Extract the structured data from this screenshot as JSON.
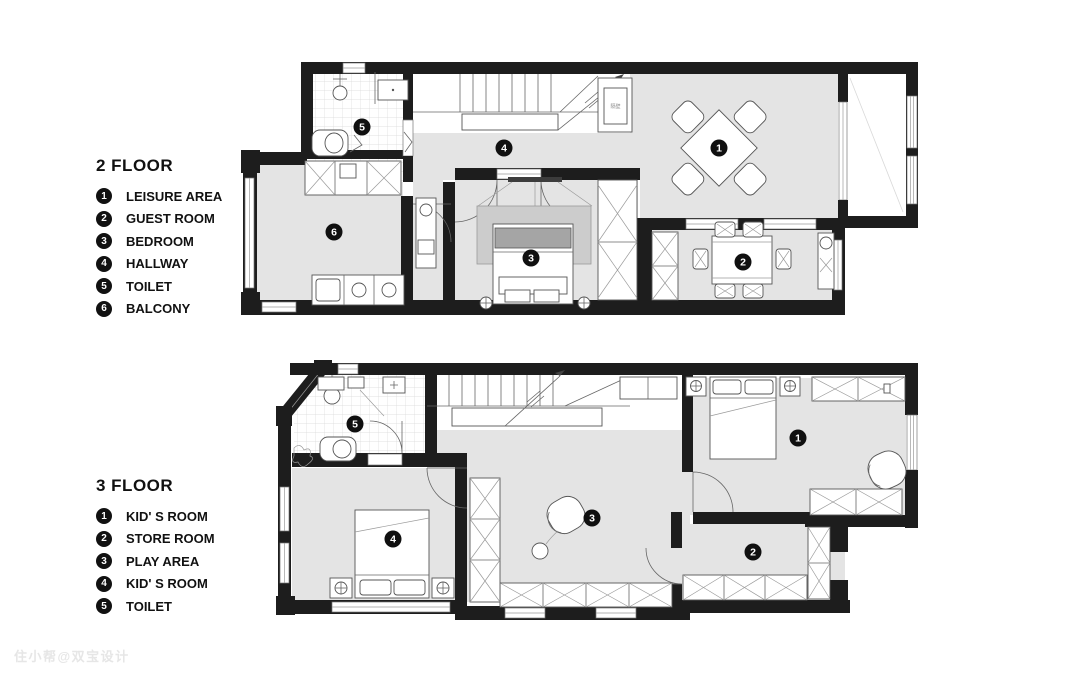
{
  "watermark": {
    "text": "住小帮@双宝设计"
  },
  "colors": {
    "wall": "#1d1d1d",
    "floor": "#e4e4e4",
    "marker": "#101010"
  },
  "floors": [
    {
      "title": "2 FLOOR",
      "flue_label": "隔壁",
      "legend": [
        {
          "num": "1",
          "label": "LEISURE AREA"
        },
        {
          "num": "2",
          "label": "GUEST ROOM"
        },
        {
          "num": "3",
          "label": "BEDROOM"
        },
        {
          "num": "4",
          "label": "HALLWAY"
        },
        {
          "num": "5",
          "label": "TOILET"
        },
        {
          "num": "6",
          "label": "BALCONY"
        }
      ],
      "markers": [
        {
          "n": "1",
          "x": 719,
          "y": 148
        },
        {
          "n": "2",
          "x": 743,
          "y": 262
        },
        {
          "n": "3",
          "x": 531,
          "y": 258
        },
        {
          "n": "4",
          "x": 504,
          "y": 148
        },
        {
          "n": "5",
          "x": 362,
          "y": 127
        },
        {
          "n": "6",
          "x": 334,
          "y": 232
        }
      ]
    },
    {
      "title": "3 FLOOR",
      "legend": [
        {
          "num": "1",
          "label": "KID' S ROOM"
        },
        {
          "num": "2",
          "label": "STORE ROOM"
        },
        {
          "num": "3",
          "label": "PLAY AREA"
        },
        {
          "num": "4",
          "label": "KID' S ROOM"
        },
        {
          "num": "5",
          "label": "TOILET"
        }
      ],
      "markers": [
        {
          "n": "1",
          "x": 798,
          "y": 438
        },
        {
          "n": "2",
          "x": 753,
          "y": 552
        },
        {
          "n": "3",
          "x": 592,
          "y": 518
        },
        {
          "n": "4",
          "x": 393,
          "y": 539
        },
        {
          "n": "5",
          "x": 355,
          "y": 424
        }
      ]
    }
  ]
}
